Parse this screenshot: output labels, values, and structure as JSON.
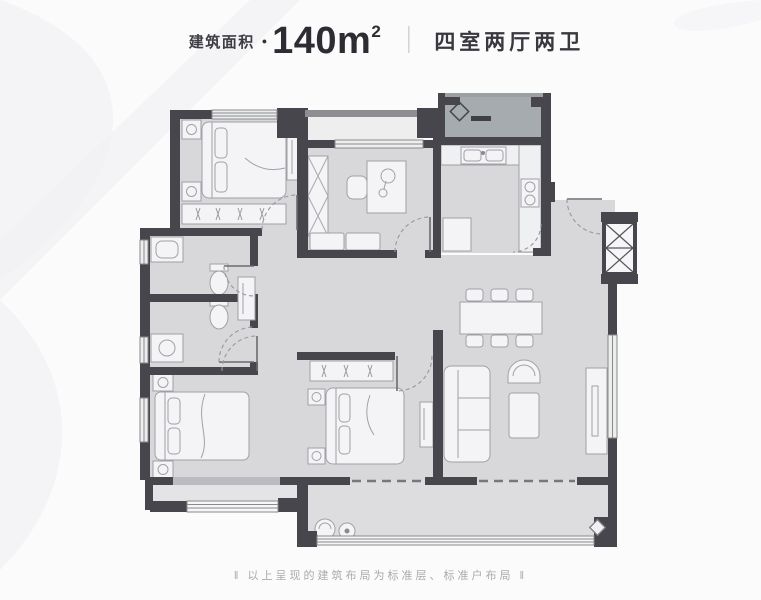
{
  "header": {
    "area_label": "建筑面积",
    "dot_icon": "●",
    "area_value": "140m",
    "area_sup": "2",
    "divider": "｜",
    "layout_type": "四室两厅两卫"
  },
  "footer": {
    "note": "‖ 以上呈现的建筑布局为标准层、标准户布局 ‖"
  },
  "floorplan": {
    "colors": {
      "wall": "#46464c",
      "room_fill": "#d8d8da",
      "balcony_fill": "#dddde0",
      "furniture_fill": "#f4f4f6",
      "equipment_platform_fill": "#a6abaf",
      "window_fill": "#eceded",
      "background": "#fbfbfc"
    }
  }
}
